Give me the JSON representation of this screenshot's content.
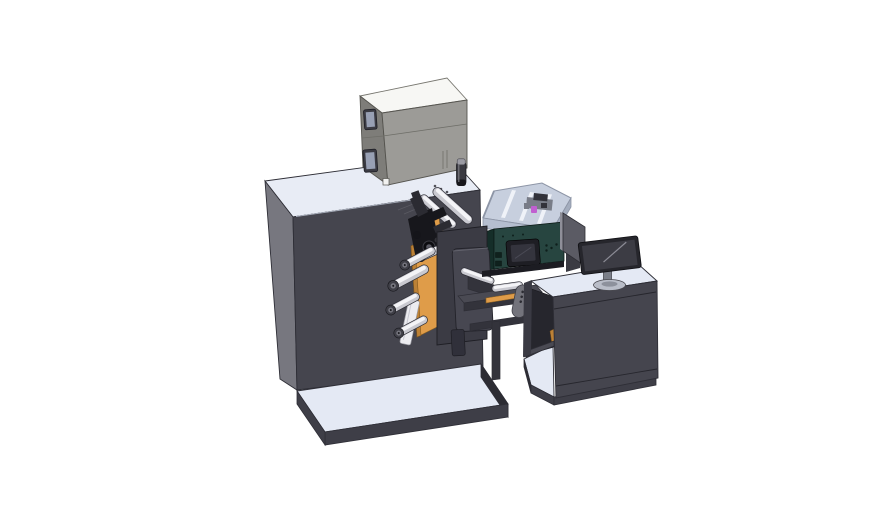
{
  "scene": {
    "type": "3d-cad-render",
    "description": "Isometric CAD rendering of a label converting machine line: main cabinet with equipment box, unwind rollers and print head, transparent process enclosure over an HMI control box, bridge frame, and an operator desk with monitor, mounted on two light baseplates",
    "background": "#ffffff"
  },
  "colors": {
    "background": "#ffffff",
    "outline": "#2e2e36",
    "edge_light": "#a9afbc",
    "cabinet_top": "#e8ecf5",
    "cabinet_left": "#77777f",
    "cabinet_front": "#45454e",
    "plat_top": "#e4e9f4",
    "plat_front": "#3e3e47",
    "plat_side": "#2c2c33",
    "box_top": "#f7f7f4",
    "box_left": "#7e7d79",
    "box_front": "#9c9b97",
    "box_seam": "#6e6e68",
    "window_frame": "#3b3b43",
    "window_glass": "#98a0b4",
    "canister_body": "#3a3a41",
    "canister_cap": "#9b9ba3",
    "canister_band": "#17171b",
    "encl_floor": "#c7cfde",
    "encl_wall": "#b5becf",
    "encl_wall_right": "#a4adbe",
    "encl_rib": "#eff2f8",
    "encl_edge": "#8d95a6",
    "encl_mech": "#787c87",
    "encl_mech_dark": "#32323a",
    "magenta": "#c05fd0",
    "teal_front": "#274540",
    "teal_left": "#152e29",
    "hmi_bezel": "#1e1e24",
    "hmi_screen": "#34343d",
    "orange": "#df9c49",
    "orange_dark": "#bc8136",
    "roller_body": "#c9c9d0",
    "roller_hi": "#f4f4f7",
    "cap_outer": "#3f3f47",
    "cap_inner": "#75757e",
    "head_dark": "#17171c",
    "head_mid": "#2b2b32",
    "plate_back": "#3b3b44",
    "plate_front": "#474751",
    "label_dark": "#0d0d11",
    "divider": "#5b5b64",
    "divider_edge": "#8f8f99",
    "monitor_bezel": "#26262c",
    "monitor_screen": "#3c3c44",
    "monitor_sheen": "#8b8b95",
    "stand": "#7a7e88",
    "stand_base": "#b9bdc8",
    "bridge_dark": "#33333b",
    "bridge_mid": "#4a4a53",
    "handle": "#73737b",
    "desk_inner": "#26262d",
    "bracket_white": "#ececf0"
  },
  "components": [
    "main-cabinet",
    "equipment-box",
    "inspection-windows",
    "filter-canister",
    "process-enclosure",
    "hmi-control-box",
    "unwind-station",
    "web-rollers",
    "print-head",
    "station-plate",
    "bridge-frame",
    "grip-handle",
    "operator-desk",
    "desk-monitor",
    "screen-divider",
    "baseplate-left",
    "baseplate-right"
  ]
}
